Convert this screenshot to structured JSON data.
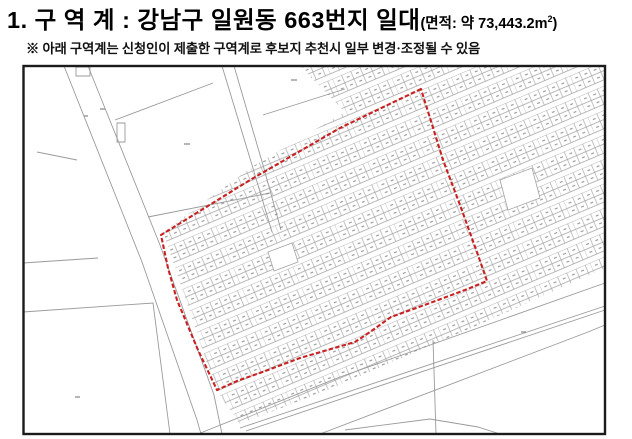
{
  "title": {
    "main": "1. 구 역 계 :  강남구 일원동 663번지 일대",
    "area_prefix": "(면적: 약 73,443.2m",
    "area_sup": "2",
    "area_suffix": ")"
  },
  "note": "※ 아래 구역계는 신청인이 제출한 구역계로 후보지 추천시 일부 변경·조정될 수 있음",
  "map": {
    "colors": {
      "frame": "#1b1b1b",
      "parcel_line": "#a2a2a2",
      "boundary_red": "#c92121",
      "parcel_number_marks": "#8a8a8a",
      "background": "#ffffff"
    },
    "frame": "23.5,66 581.5x368",
    "dense_clip_points": "300,66 605,66 605,268 460,333 340,385 240,424 216,390 163,232 255,165 345,112",
    "red_boundary_points": "421,89 400,99 340,128 250,180 161,235 168,268 177,300 198,350 217,390 237,381 268,370 300,358 355,342 370,332 391,317 430,303 465,290 487,281 478,255 460,205 443,160 430,118",
    "paths": {
      "left_road": "M64,66 L142,262 L197,420 L201,434 M88,66 L160,245 L214,395 L222,434",
      "upper_parcels": "M115,120 L213,83 M222,66 L252,165 L272,232 M234,66 L263,165 L281,230 M263,115 L345,89 M148,217 L270,193 M37,152 L77,160 M76,67 L90,67 L90,76 L76,76 Z M117,123 L125,123 L125,142 L117,142 Z",
      "lower_parcels": "M23,263 L98,258 M23,312 L153,303 L170,434 M433,340 L436,434",
      "roads": "M198,434 L340,377 L605,283 M320,434 L588,332 L605,325 M240,428 L605,306 M246,431 L605,310 M345,430 L430,419 L478,427 L500,434",
      "label_marks": "M184,144 h6 M291,80 h6 M100,109 h5 M75,397 h5 M521,332 h5 M84,116 h4"
    },
    "blank_block_points": "500,180 532,168 540,198 508,210",
    "blank_block2_points": "268,252 292,243 298,262 274,271"
  }
}
